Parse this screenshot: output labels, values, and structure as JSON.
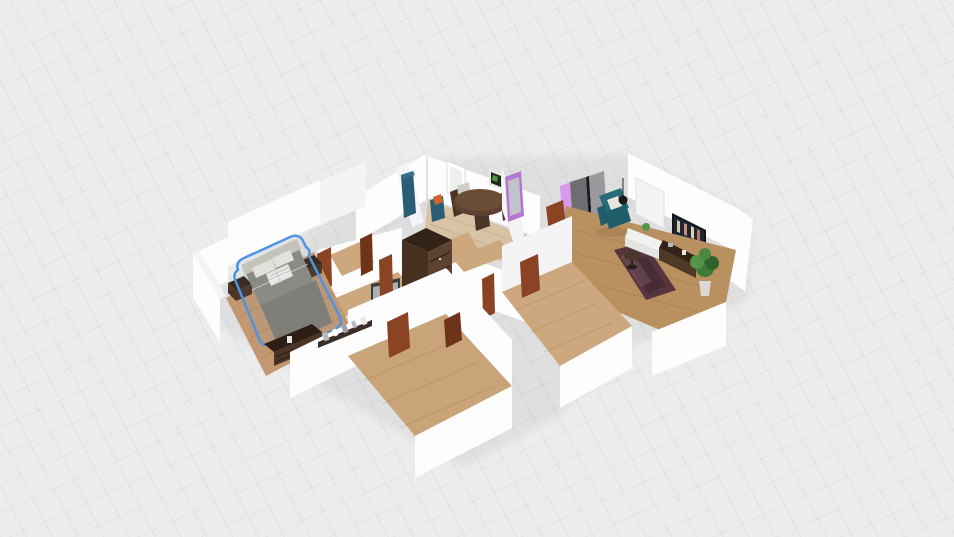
{
  "viewport": {
    "type": "3d-floorplan-isometric-view",
    "width_px": 954,
    "height_px": 537,
    "background": "light gray ground plane with faint diagonal grid",
    "ui_chrome": "none visible, render viewport only"
  },
  "selection": {
    "selected_item": "double-bed",
    "selected_room": "bedroom",
    "outline_style": "hand-drawn blue lasso outline"
  },
  "rooms": [
    {
      "id": "bedroom",
      "position": "left",
      "floor": "medium wood planks",
      "items": [
        "double-bed (selected)",
        "nightstand-left",
        "nightstand-right",
        "dresser-with-items",
        "gray-wall-tv"
      ]
    },
    {
      "id": "kitchen-dining",
      "position": "top-center",
      "floor": "pale wood",
      "items": [
        "blue-kitchen-counter",
        "blue-cabinet-with-stove",
        "round-dining-table",
        "dining-chairs",
        "framed-wall-art",
        "window",
        "purple-door"
      ]
    },
    {
      "id": "living-room",
      "position": "right",
      "floor": "wood planks",
      "items": [
        "sliding-door-closet",
        "purple-panel",
        "teal-armchair",
        "white-throw-pillow",
        "pendant-lamp",
        "round-side-table",
        "white-sideboard",
        "media-tv",
        "tv-console",
        "potted-plant",
        "dark-patterned-rug",
        "window-pane",
        "open-brown-door"
      ]
    },
    {
      "id": "hallway",
      "position": "center",
      "floor": "pale wood",
      "items": [
        "dark-brown-wardrobe"
      ]
    },
    {
      "id": "room-bottom-left",
      "position": "bottom-left",
      "floor": "wood planks",
      "items": [
        "counter-with-small-appliances"
      ]
    },
    {
      "id": "room-bottom-middle",
      "position": "bottom-center",
      "floor": "wood planks",
      "items": []
    }
  ],
  "doors": {
    "open_brown_doors": 9,
    "purple_doors": 2,
    "windows": 2
  },
  "colors": {
    "bg": "#ececec",
    "wallBright": "#fdfdfe",
    "wallLight": "#f4f4f6",
    "wallShade": "#e9e9ec",
    "wallDark": "#dfdfe3",
    "floorWood": "#c29872",
    "floorWoodLight": "#d8c4a4",
    "floorWoodPale": "#cda87e",
    "doorBrown": "#8a4423",
    "doorBrownDark": "#6e3319",
    "wardrobeDark": "#46311f",
    "wardrobeMid": "#5d4330",
    "wardrobeTop": "#332217",
    "counterBlue": "#2a5e74",
    "stoveOrange": "#d2622a",
    "purpleDoor": "#d79aec",
    "purpleFrame": "#b478d0",
    "closetGrayDark": "#6e6e72",
    "closetGrayLight": "#9a9a9e",
    "armchairTeal": "#2a6b7a",
    "armchairTealDark": "#1f5d6b",
    "bedDuvet": "#8f8a80",
    "bedDuvetDark": "#827d74",
    "bedHeadboard": "#cbc4b8",
    "pillowWhite": "#e8e5de",
    "selectionBlue": "#4f94e0",
    "rugMaroon": "#57353f",
    "rugMaroonDark": "#3f2630",
    "tvScreenDark": "#1c2635",
    "tvFrame": "#14181e",
    "tvGrayScreen": "#aab0b4",
    "tvGrayFrame": "#3c3c40",
    "tableWood": "#5d4130",
    "chairDark": "#4a3526",
    "plantGreen": "#3e7a38",
    "plantGreenLight": "#57944b",
    "potWhite": "#d8d8d4",
    "consoleBrown": "#4e3826",
    "sideboardWhite": "#f2f2f0",
    "counterDark": "#3a2e26",
    "itemGray": "#b8bcc0"
  }
}
